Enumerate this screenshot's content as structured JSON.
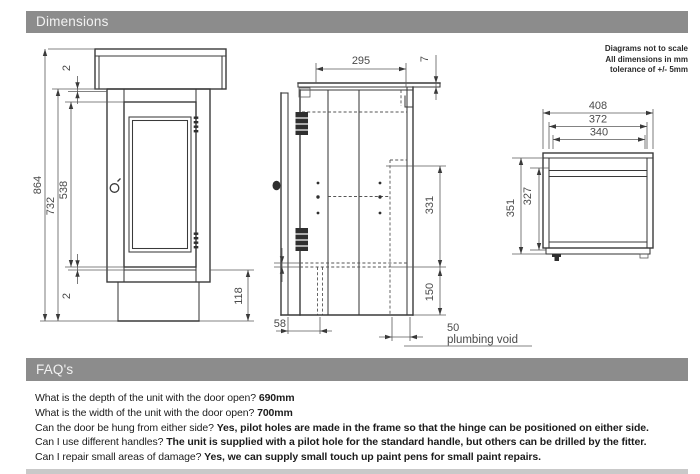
{
  "sections": {
    "dimensions_title": "Dimensions",
    "faqs_title": "FAQ's"
  },
  "note": {
    "line1": "Diagrams not to scale",
    "line2": "All dimensions in mm",
    "line3": "tolerance of +/- 5mm"
  },
  "front_view": {
    "overall_height": "864",
    "carcass_height": "732",
    "door_height": "538",
    "door_gap_top": "2",
    "door_gap_bottom": "2",
    "plinth_height": "118"
  },
  "side_view": {
    "depth": "295",
    "worktop_lip": "7",
    "back_opening_height": "331",
    "lower_void_height": "150",
    "plinth_recess": "58",
    "plumbing_void_depth": "50",
    "plumbing_void_label": "plumbing void"
  },
  "plan_view": {
    "overall_width": "408",
    "mid_width": "372",
    "internal_width": "340",
    "overall_depth": "351",
    "internal_depth": "327"
  },
  "faqs": [
    {
      "q": "What is the depth of the unit with the door open?",
      "a": "690mm"
    },
    {
      "q": "What is the width of the unit with the door open?",
      "a": "700mm"
    },
    {
      "q": "Can the door be hung from either side?",
      "a": "Yes, pilot holes are made in the frame so that the hinge can be positioned on either side."
    },
    {
      "q": "Can I use different handles?",
      "a": "The unit is supplied with a pilot hole for the standard handle, but others can be drilled by the fitter."
    },
    {
      "q": "Can I repair small areas of damage?",
      "a": "Yes, we can supply small touch up paint pens for small paint repairs."
    }
  ]
}
